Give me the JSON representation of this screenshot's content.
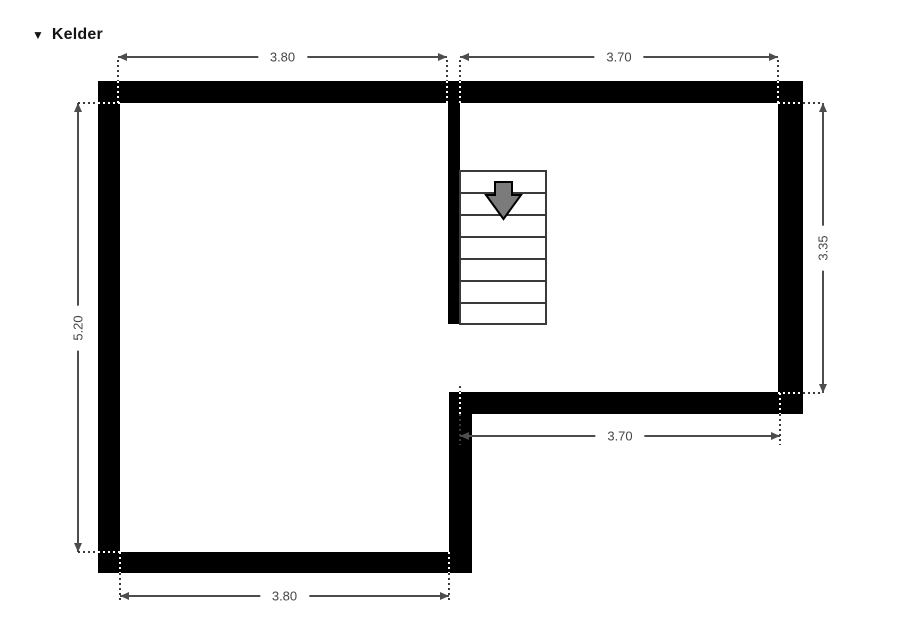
{
  "header": {
    "collapse_icon": "▼",
    "title": "Kelder"
  },
  "floorplan": {
    "dimensions": {
      "top_left_width": "3.80",
      "top_right_width": "3.70",
      "left_height": "5.20",
      "right_height": "3.35",
      "inner_bottom_width": "3.70",
      "bottom_width": "3.80"
    },
    "stairs": {
      "steps": 7,
      "arrow_direction": "down"
    },
    "colors": {
      "wall": "#000000",
      "dimension_line": "#4d4d4d",
      "dimension_text": "#464646",
      "stairs_outline": "#3a3a3a",
      "stairs_arrow_fill": "#7b7b7b",
      "background": "#ffffff"
    }
  }
}
